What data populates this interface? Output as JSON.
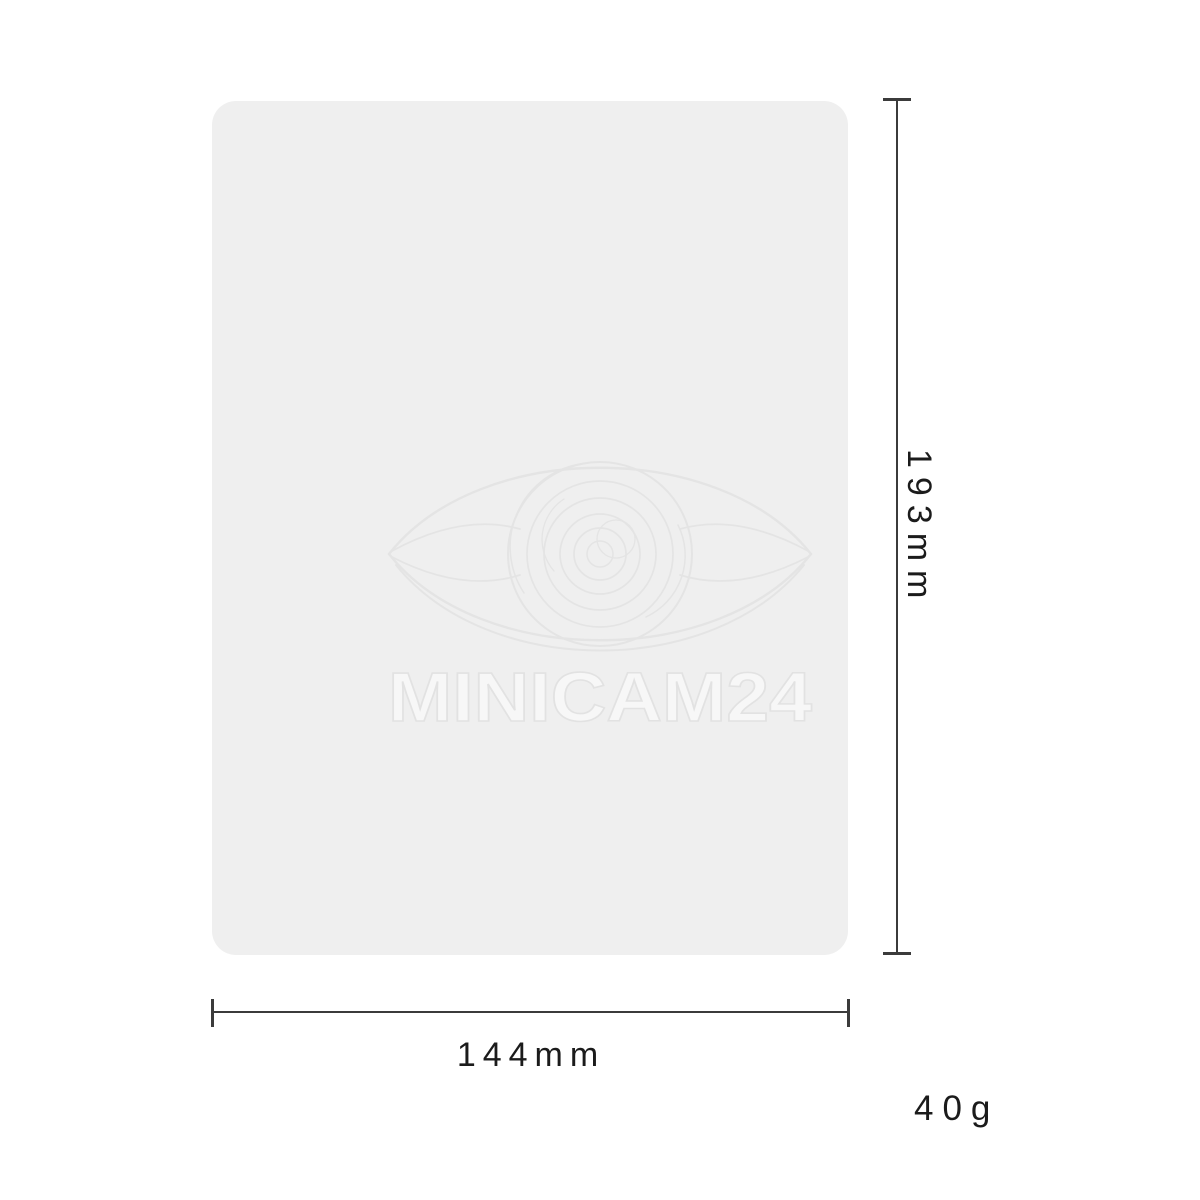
{
  "diagram": {
    "brand_watermark": "MINICAM24",
    "height_label": "193mm",
    "width_label": "144mm",
    "weight_label": "40g",
    "colors": {
      "background": "#ffffff",
      "panel": "#efefef",
      "dimension_line": "#3b3b3b",
      "label_text": "#1b1b1b",
      "watermark_stroke": "#e4e4e4"
    }
  }
}
